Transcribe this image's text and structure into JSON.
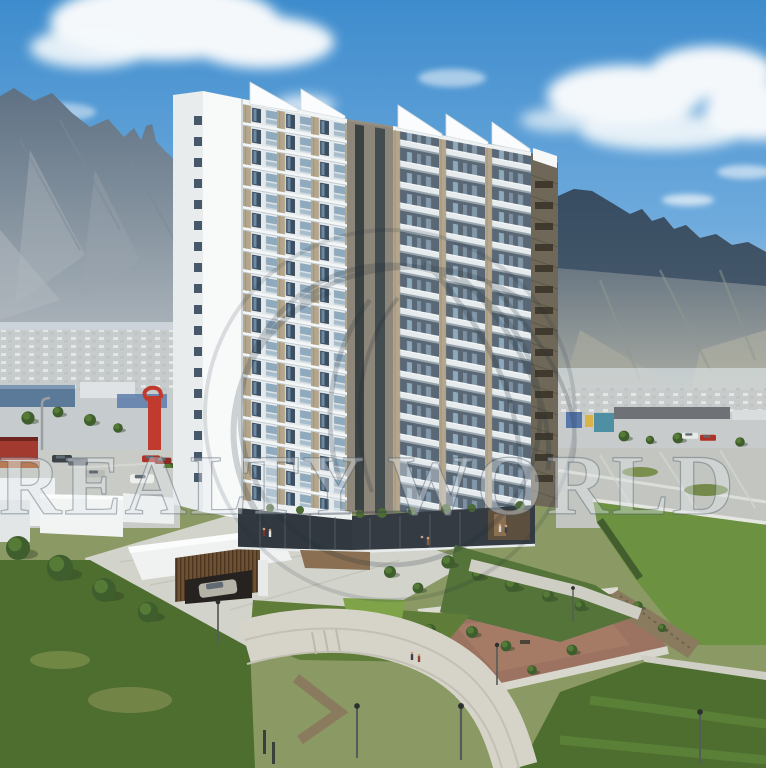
{
  "watermark": {
    "text": "REALTY WORLD",
    "logo": "realty-world-globe-swirl"
  },
  "palette": {
    "sky_top": "#3e8ccd",
    "sky_horizon": "#c6dcee",
    "cloud": "#f4f8fb",
    "mountain_left": "#5d7083",
    "mountain_right": "#3f536a",
    "building_white": "#f8fafa",
    "building_stone": "#b3a68c",
    "building_glass": "#3c4e60",
    "balcony_glass": "#8fa9bd",
    "podium_glass": "#31383f",
    "lawn_main": "#6c9140",
    "lawn_dark": "#4e6e2f",
    "playground": "#9c7260",
    "concrete": "#d2d3cb",
    "wood_canopy": "#6e5132",
    "red_accent": "#c03a2e"
  }
}
